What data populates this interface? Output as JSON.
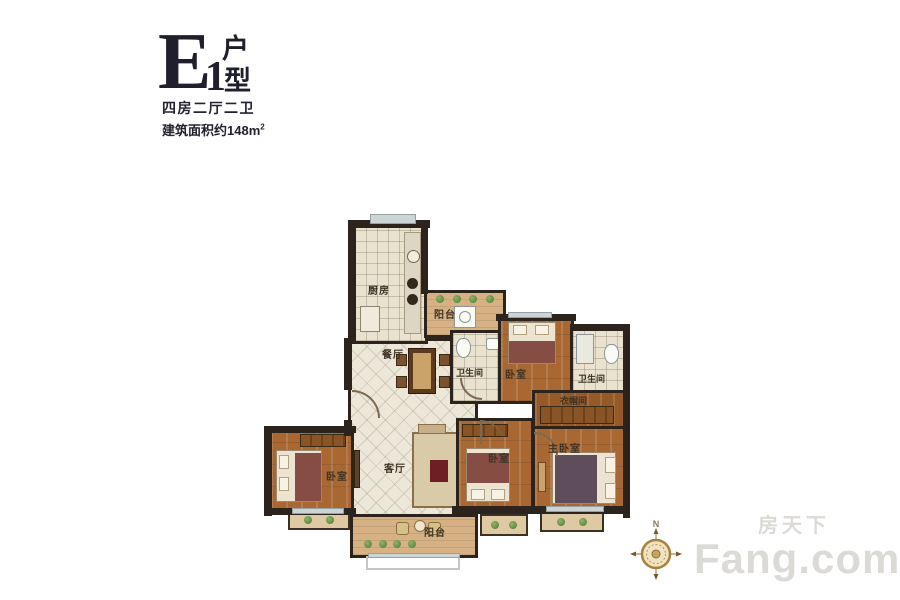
{
  "title": {
    "letter": "E",
    "number": "1",
    "suffix_top": "户",
    "suffix_bottom": "型",
    "layout": "四房二厅二卫",
    "area_prefix": "建筑面积约148m",
    "area_sup": "2"
  },
  "rooms": {
    "kitchen": {
      "label": "厨房"
    },
    "service_balcony": {
      "label": "阳台"
    },
    "dining": {
      "label": "餐厅"
    },
    "bath_center": {
      "label": "卫生间"
    },
    "bedroom_north": {
      "label": "卧室"
    },
    "bath_east": {
      "label": "卫生间"
    },
    "closet": {
      "label": "衣帽间"
    },
    "living": {
      "label": "客厅"
    },
    "bedroom_west": {
      "label": "卧室"
    },
    "bedroom_middle": {
      "label": "卧室"
    },
    "master_bedroom": {
      "label": "主卧室"
    },
    "main_balcony": {
      "label": "阳台"
    }
  },
  "compass": {
    "north": "N"
  },
  "watermark": {
    "line1": "房天下",
    "line2": "Fang.com"
  },
  "colors": {
    "wall": "#2b231c",
    "wood_floor": "#a96832",
    "tile_floor": "#ece7d9",
    "balcony_floor": "#d6b184",
    "title_text": "#20202c",
    "watermark_text": "#a8a399"
  }
}
